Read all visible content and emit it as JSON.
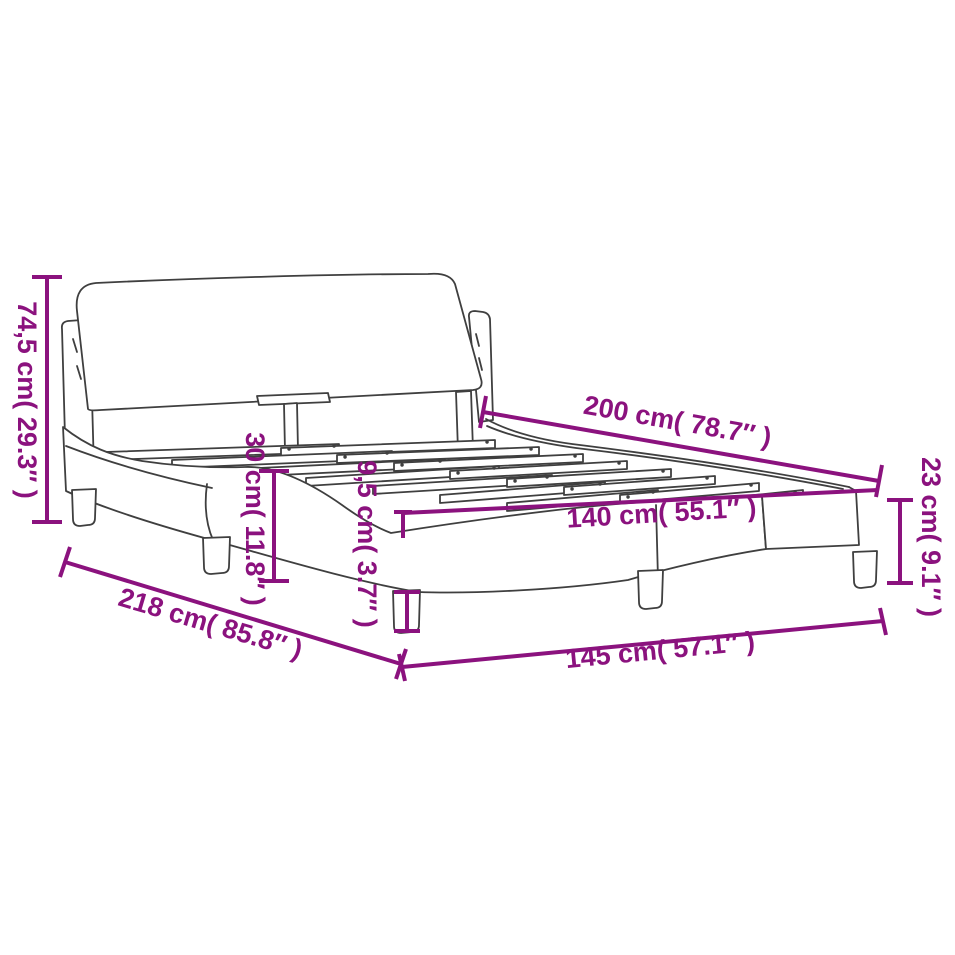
{
  "diagram": {
    "type": "product-dimension-diagram",
    "subject": "bed-frame-with-headboard-and-slatted-base",
    "background_color": "#ffffff",
    "accent_color": "#8B127E",
    "drawing_line_color": "#3F3F3F",
    "labels": {
      "total_height": "74,5 cm( 29.3″ )",
      "total_length": "218 cm( 85.8″ )",
      "inner_length": "200 cm( 78.7″ )",
      "inner_width": "140 cm( 55.1″ )",
      "total_width": "145 cm( 57.1″ )",
      "foot_frame_height": "23 cm( 9.1″ )",
      "rail_height": "30 cm( 11.8″ )",
      "leg_height": "9,5 cm( 3.7″ )"
    },
    "measurements": [
      {
        "cm": "74,5",
        "inch": "29.3"
      },
      {
        "cm": "218",
        "inch": "85.8"
      },
      {
        "cm": "200",
        "inch": "78.7"
      },
      {
        "cm": "140",
        "inch": "55.1"
      },
      {
        "cm": "145",
        "inch": "57.1"
      },
      {
        "cm": "23",
        "inch": "9.1"
      },
      {
        "cm": "30",
        "inch": "11.8"
      },
      {
        "cm": "9,5",
        "inch": "3.7"
      }
    ]
  }
}
